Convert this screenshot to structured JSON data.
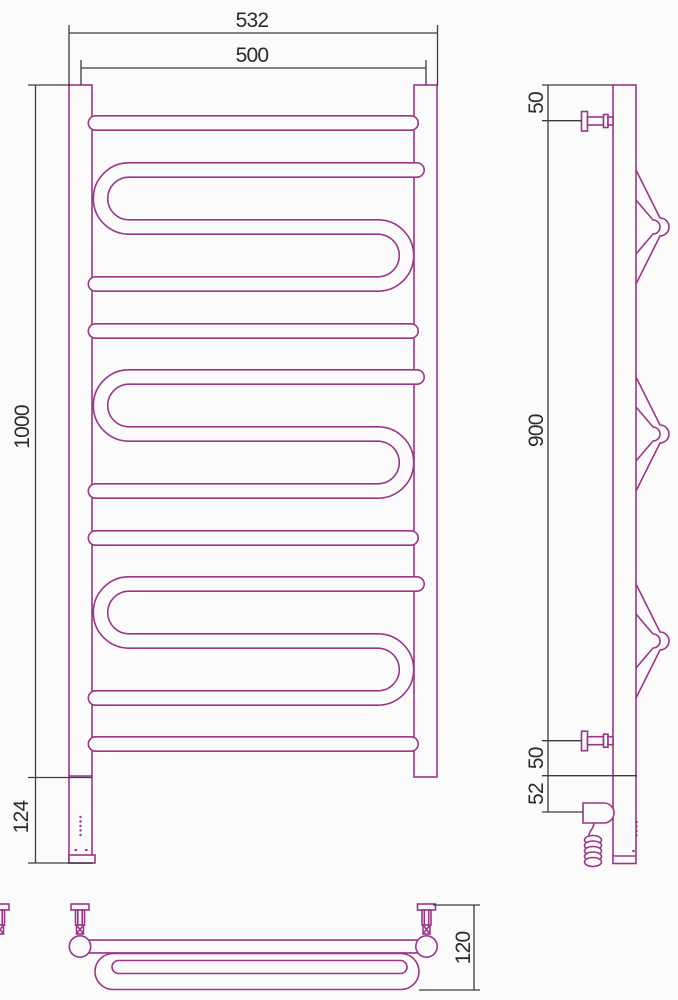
{
  "drawing_kind": "heated-towel-rail-technical-drawing",
  "colors": {
    "part_outline": "#9a3588",
    "dimension_lines": "#3c3c3c",
    "label_text": "#2b2b2b",
    "background": "#fcfbfc"
  },
  "views": {
    "front": {
      "dims": {
        "overall_width": "532",
        "axis_width": "500",
        "height": "1000",
        "heater_section": "124"
      }
    },
    "side": {
      "dims": {
        "top_bracket_offset": "50",
        "bracket_span": "900",
        "bottom_bracket_offset": "50",
        "power_unit_offset": "52"
      }
    },
    "bottom": {
      "dims": {
        "depth": "120"
      }
    }
  }
}
